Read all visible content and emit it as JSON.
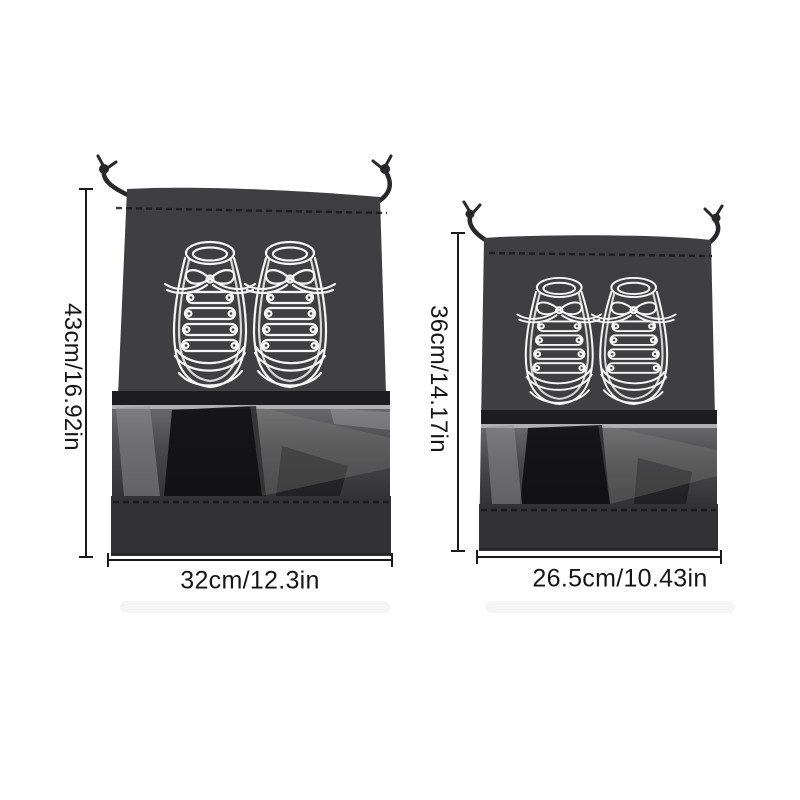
{
  "diagram": {
    "bags": {
      "large": {
        "height_label": "43cm/16.92in",
        "width_label": "32cm/12.3in"
      },
      "small": {
        "height_label": "36cm/14.17in",
        "width_label": "26.5cm/10.43in"
      }
    },
    "colors": {
      "background": "#ffffff",
      "bag_fabric": "#3f3f41",
      "bag_band": "#323234",
      "bag_fold": "#1d1d1f",
      "cord": "#28282a",
      "shoe_outline": "#f5f5f5",
      "dimension_line": "#1a1a1a",
      "label_text": "#161616"
    }
  }
}
